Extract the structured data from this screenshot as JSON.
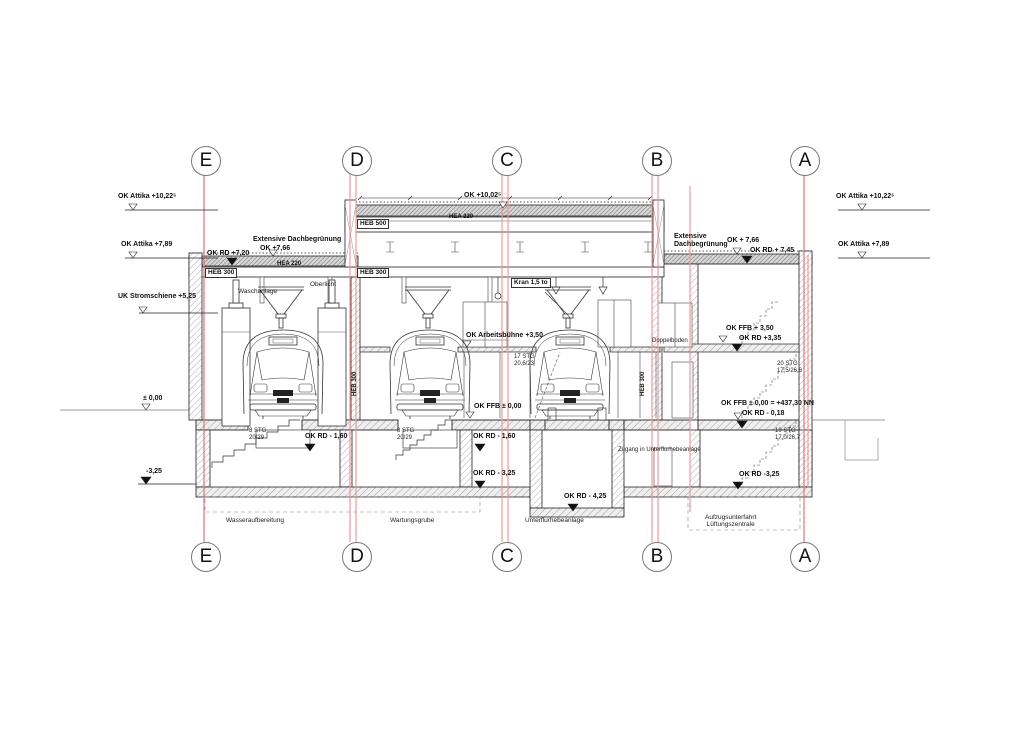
{
  "drawing": {
    "type": "building-section",
    "accent_grid_color": "#ef9a9a",
    "line_color": "#333333"
  },
  "grid": {
    "e": "E",
    "d": "D",
    "c": "C",
    "b": "B",
    "a": "A"
  },
  "levels": {
    "left": {
      "attika_high": "OK Attika +10,22⁵",
      "attika_low": "OK Attika +7,89",
      "stromschiene": "UK Stromschiene +5,25",
      "zero": "± 0,00",
      "minus_325": "-3,25"
    },
    "right": {
      "attika_high": "OK Attika +10,22⁵",
      "attika_low": "OK Attika +7,89"
    }
  },
  "roof": {
    "dach_left": "Extensive Dachbegrünung",
    "ok_766_left": "OK +7,66",
    "ok_rd_720": "OK RD +7,20",
    "hea_220_left": "HEA 220",
    "heb_300_left": "HEB 300",
    "ok_1002": "OK +10,02⁵",
    "hea_220_mid": "HEA 220",
    "heb_500": "HEB 500",
    "heb_300_mid": "HEB 300",
    "dach_right": "Extensive\nDachbegrünung",
    "ok_766_right": "OK + 7,66",
    "ok_rd_745": "OK RD + 7,45"
  },
  "hall": {
    "waschanlage": "Waschanlage",
    "oberlicht": "Oberlicht",
    "kran": "Kran 1,5 to",
    "arbeitsbuehne": "OK Arbeitsbühne +3,50",
    "stg_17": "17 STG\n20,6/23",
    "doppelboden": "Doppelboden",
    "heb_300_vert": "HEB 300",
    "ffb_zero": "OK FFB ± 0,00"
  },
  "annex": {
    "ffb_350": "OK FFB + 3,50",
    "rd_335": "OK RD +3,35",
    "stg_20": "20 STG\n17,5/26,6",
    "ffb_zero_nn": "OK FFB ± 0,00 = +437,30 NN",
    "rd_minus_018": "OK RD - 0,18",
    "stg_19": "19 STG\n17,0/26,7",
    "rd_minus_325": "OK RD -3,25"
  },
  "basement": {
    "stg_8": "8 STG\n20/29",
    "rd_minus_160": "OK RD - 1,60",
    "rd_minus_325": "OK RD - 3,25",
    "rd_minus_425": "OK RD - 4,25",
    "zugang": "Zugang in Unterflurhebeanlage"
  },
  "rooms": {
    "wasseraufbereitung": "Wasseraufbereitung",
    "wartungsgrube": "Wartungsgrube",
    "unterflurhebeanlage": "Unterflurhebeanlage",
    "aufzug": "Aufzugsunterfahrt\nLüftungszentrale"
  }
}
